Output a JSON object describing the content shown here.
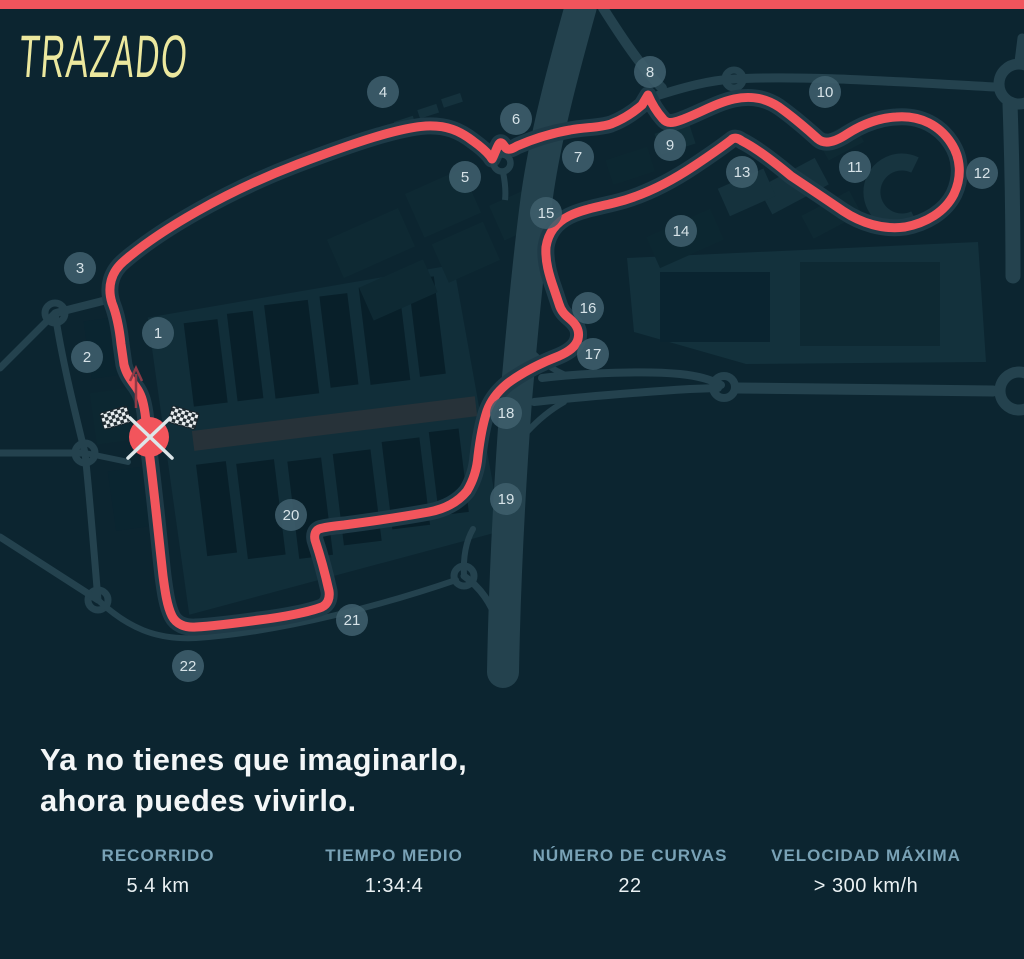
{
  "header": {
    "title": "TRAZADO"
  },
  "headline": {
    "line1": "Ya no tienes que imaginarlo,",
    "line2": "ahora puedes vivirlo."
  },
  "stats": [
    {
      "label": "RECORRIDO",
      "value": "5.4 km"
    },
    {
      "label": "TIEMPO MEDIO",
      "value": "1:34:4"
    },
    {
      "label": "NÚMERO DE CURVAS",
      "value": "22"
    },
    {
      "label": "VELOCIDAD MÁXIMA",
      "value": "> 300 km/h"
    }
  ],
  "map": {
    "corners": [
      {
        "n": "1",
        "x": 158,
        "y": 333
      },
      {
        "n": "2",
        "x": 87,
        "y": 357
      },
      {
        "n": "3",
        "x": 80,
        "y": 268
      },
      {
        "n": "4",
        "x": 383,
        "y": 92
      },
      {
        "n": "5",
        "x": 465,
        "y": 177
      },
      {
        "n": "6",
        "x": 516,
        "y": 119
      },
      {
        "n": "7",
        "x": 578,
        "y": 157
      },
      {
        "n": "8",
        "x": 650,
        "y": 72
      },
      {
        "n": "9",
        "x": 670,
        "y": 145
      },
      {
        "n": "10",
        "x": 825,
        "y": 92
      },
      {
        "n": "11",
        "x": 855,
        "y": 167
      },
      {
        "n": "12",
        "x": 982,
        "y": 173
      },
      {
        "n": "13",
        "x": 742,
        "y": 172
      },
      {
        "n": "14",
        "x": 681,
        "y": 231
      },
      {
        "n": "15",
        "x": 546,
        "y": 213
      },
      {
        "n": "16",
        "x": 588,
        "y": 308
      },
      {
        "n": "17",
        "x": 593,
        "y": 354
      },
      {
        "n": "18",
        "x": 506,
        "y": 413
      },
      {
        "n": "19",
        "x": 506,
        "y": 499
      },
      {
        "n": "20",
        "x": 291,
        "y": 515
      },
      {
        "n": "21",
        "x": 352,
        "y": 620
      },
      {
        "n": "22",
        "x": 188,
        "y": 666
      }
    ],
    "start_finish": {
      "x": 149,
      "y": 437,
      "icon": "crossed-checkered-flags"
    },
    "direction_arrow": "up",
    "colors": {
      "background": "#0C2530",
      "track": "#F2555C",
      "accent_bar": "#F0545C",
      "roads": "#24424E",
      "title": "#ECE89E",
      "stat_label": "#79A2B6",
      "marker_fill": "#3F5F6C"
    }
  }
}
